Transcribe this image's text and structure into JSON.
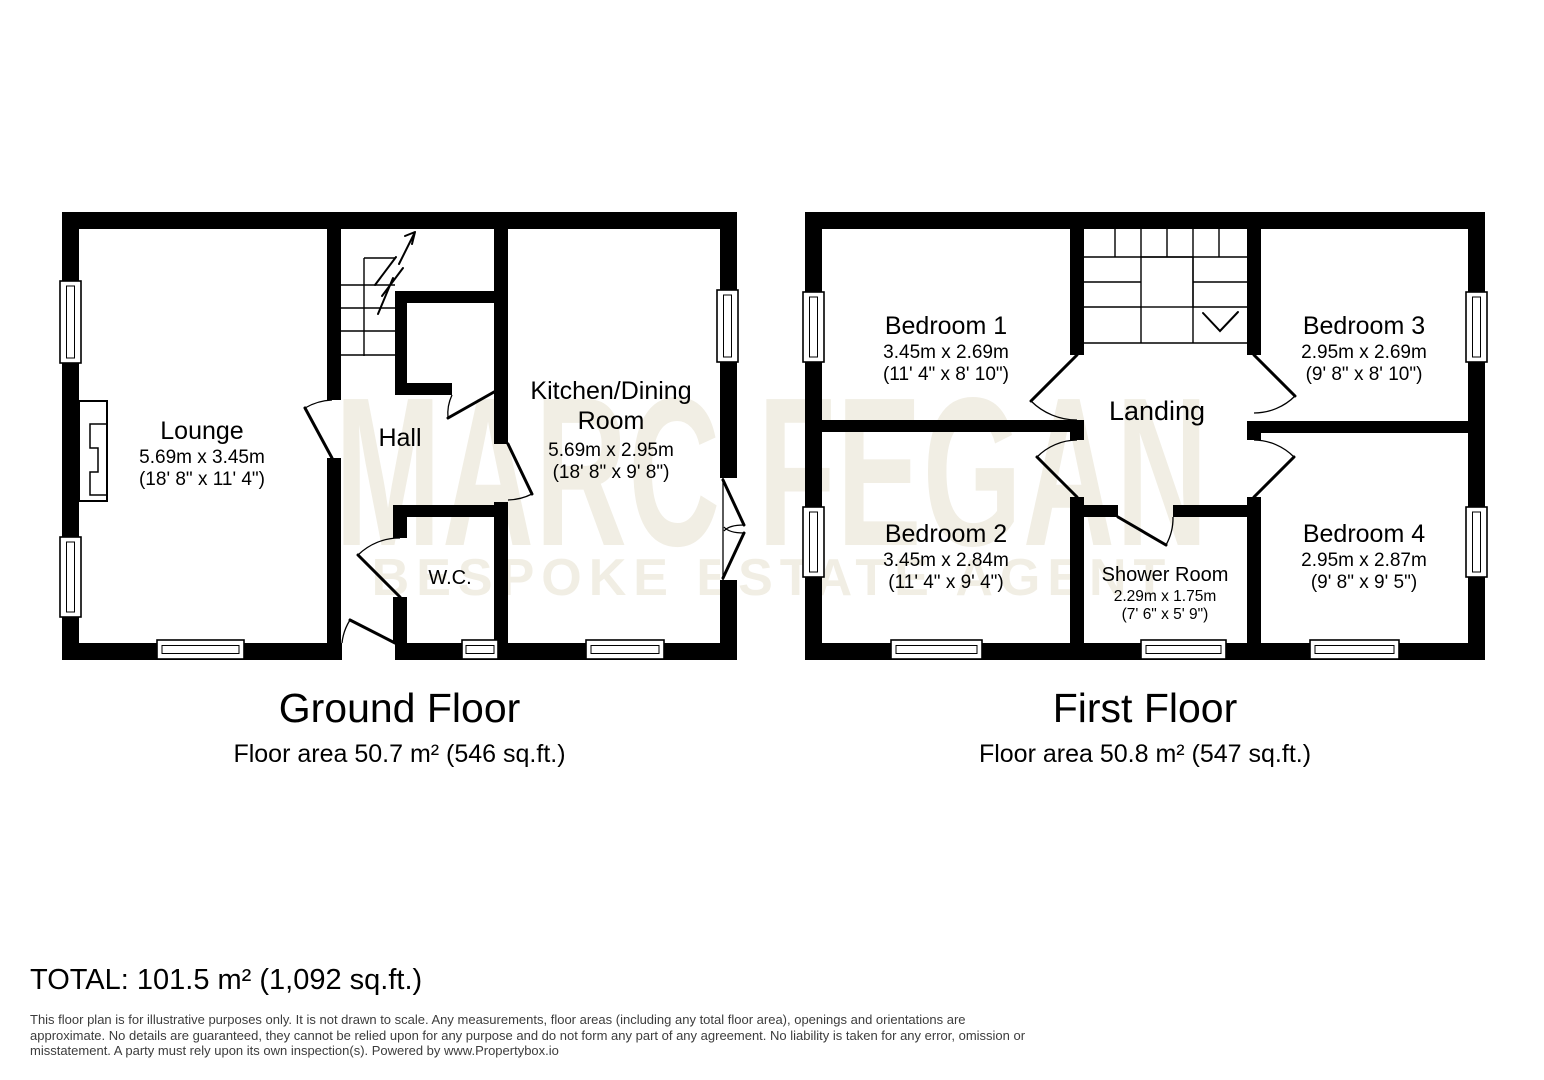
{
  "watermark": {
    "line1": "MARC FEGAN",
    "line2": "BESPOKE ESTATE AGENT",
    "color": "#f1eee4"
  },
  "ground_floor": {
    "title": "Ground Floor",
    "area": "Floor area 50.7 m² (546 sq.ft.)",
    "rooms": {
      "lounge": {
        "name": "Lounge",
        "dims_metric": "5.69m x 3.45m",
        "dims_imperial": "(18' 8\" x 11' 4\")"
      },
      "hall": {
        "name": "Hall"
      },
      "kitchen": {
        "name_line1": "Kitchen/Dining",
        "name_line2": "Room",
        "dims_metric": "5.69m x 2.95m",
        "dims_imperial": "(18' 8\" x 9' 8\")"
      },
      "wc": {
        "name": "W.C."
      }
    }
  },
  "first_floor": {
    "title": "First Floor",
    "area": "Floor area 50.8 m² (547 sq.ft.)",
    "rooms": {
      "bedroom1": {
        "name": "Bedroom 1",
        "dims_metric": "3.45m x 2.69m",
        "dims_imperial": "(11' 4\" x 8' 10\")"
      },
      "bedroom2": {
        "name": "Bedroom 2",
        "dims_metric": "3.45m x 2.84m",
        "dims_imperial": "(11' 4\" x 9' 4\")"
      },
      "bedroom3": {
        "name": "Bedroom 3",
        "dims_metric": "2.95m x 2.69m",
        "dims_imperial": "(9' 8\" x 8' 10\")"
      },
      "bedroom4": {
        "name": "Bedroom 4",
        "dims_metric": "2.95m x 2.87m",
        "dims_imperial": "(9' 8\" x 9' 5\")"
      },
      "landing": {
        "name": "Landing"
      },
      "shower": {
        "name": "Shower Room",
        "dims_metric": "2.29m x 1.75m",
        "dims_imperial": "(7' 6\" x 5' 9\")"
      }
    }
  },
  "total": "TOTAL: 101.5 m² (1,092 sq.ft.)",
  "disclaimer": {
    "line1": "This floor plan is for illustrative purposes only. It is not drawn to scale. Any measurements, floor areas (including any total floor area), openings and orientations are",
    "line2": "approximate. No details are guaranteed, they cannot be relied upon for any purpose and do not form any part of any agreement. No liability is taken for any error, omission or",
    "line3": "misstatement. A party must rely upon its own inspection(s). Powered by www.Propertybox.io"
  },
  "colors": {
    "wall": "#000000",
    "watermark": "#f1eee4",
    "disclaimer_text": "#3c3c3c",
    "background": "#ffffff"
  }
}
